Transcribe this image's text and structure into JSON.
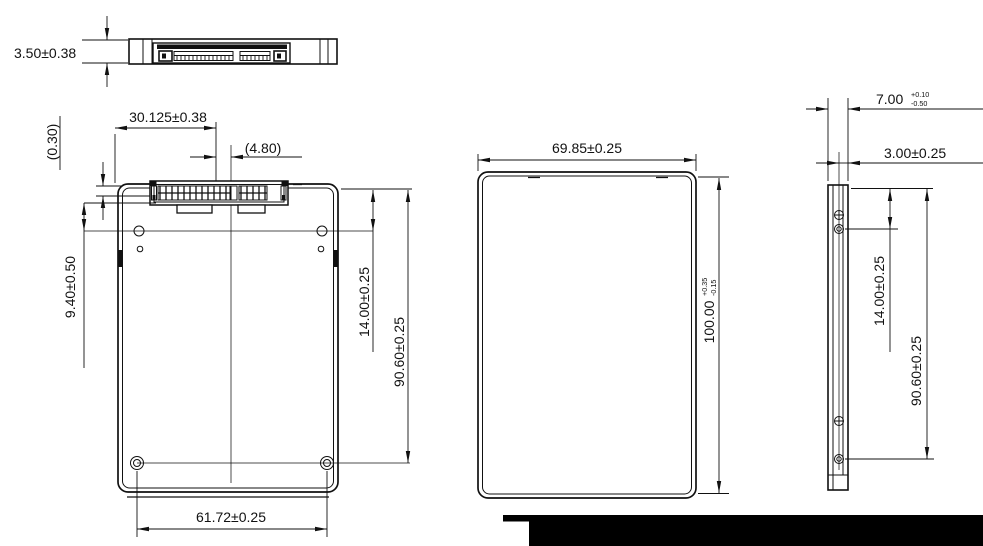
{
  "colors": {
    "ink": "#111111",
    "background": "#ffffff",
    "footer_bar": "#000000"
  },
  "dimensions": {
    "thickness": "3.50±0.38",
    "connector_offset": "30.125±0.38",
    "connector_recess": "(0.30)",
    "connector_to_center": "(4.80)",
    "side_hole_from_edge": "9.40±0.50",
    "hole_from_top_left_view": "14.00±0.25",
    "hole_span_left_view": "90.60±0.25",
    "bottom_hole_spacing": "61.72±0.25",
    "body_width": "69.85±0.25",
    "body_length_value": "100.00",
    "body_length_tol_plus": "+0.35",
    "body_length_tol_minus": "-0.15",
    "body_height_value": "7.00",
    "body_height_tol_plus": "+0.10",
    "body_height_tol_minus": "-0.50",
    "hole_face_offset": "3.00±0.25",
    "hole_from_top_right_view": "14.00±0.25",
    "hole_span_right_view": "90.60±0.25"
  }
}
